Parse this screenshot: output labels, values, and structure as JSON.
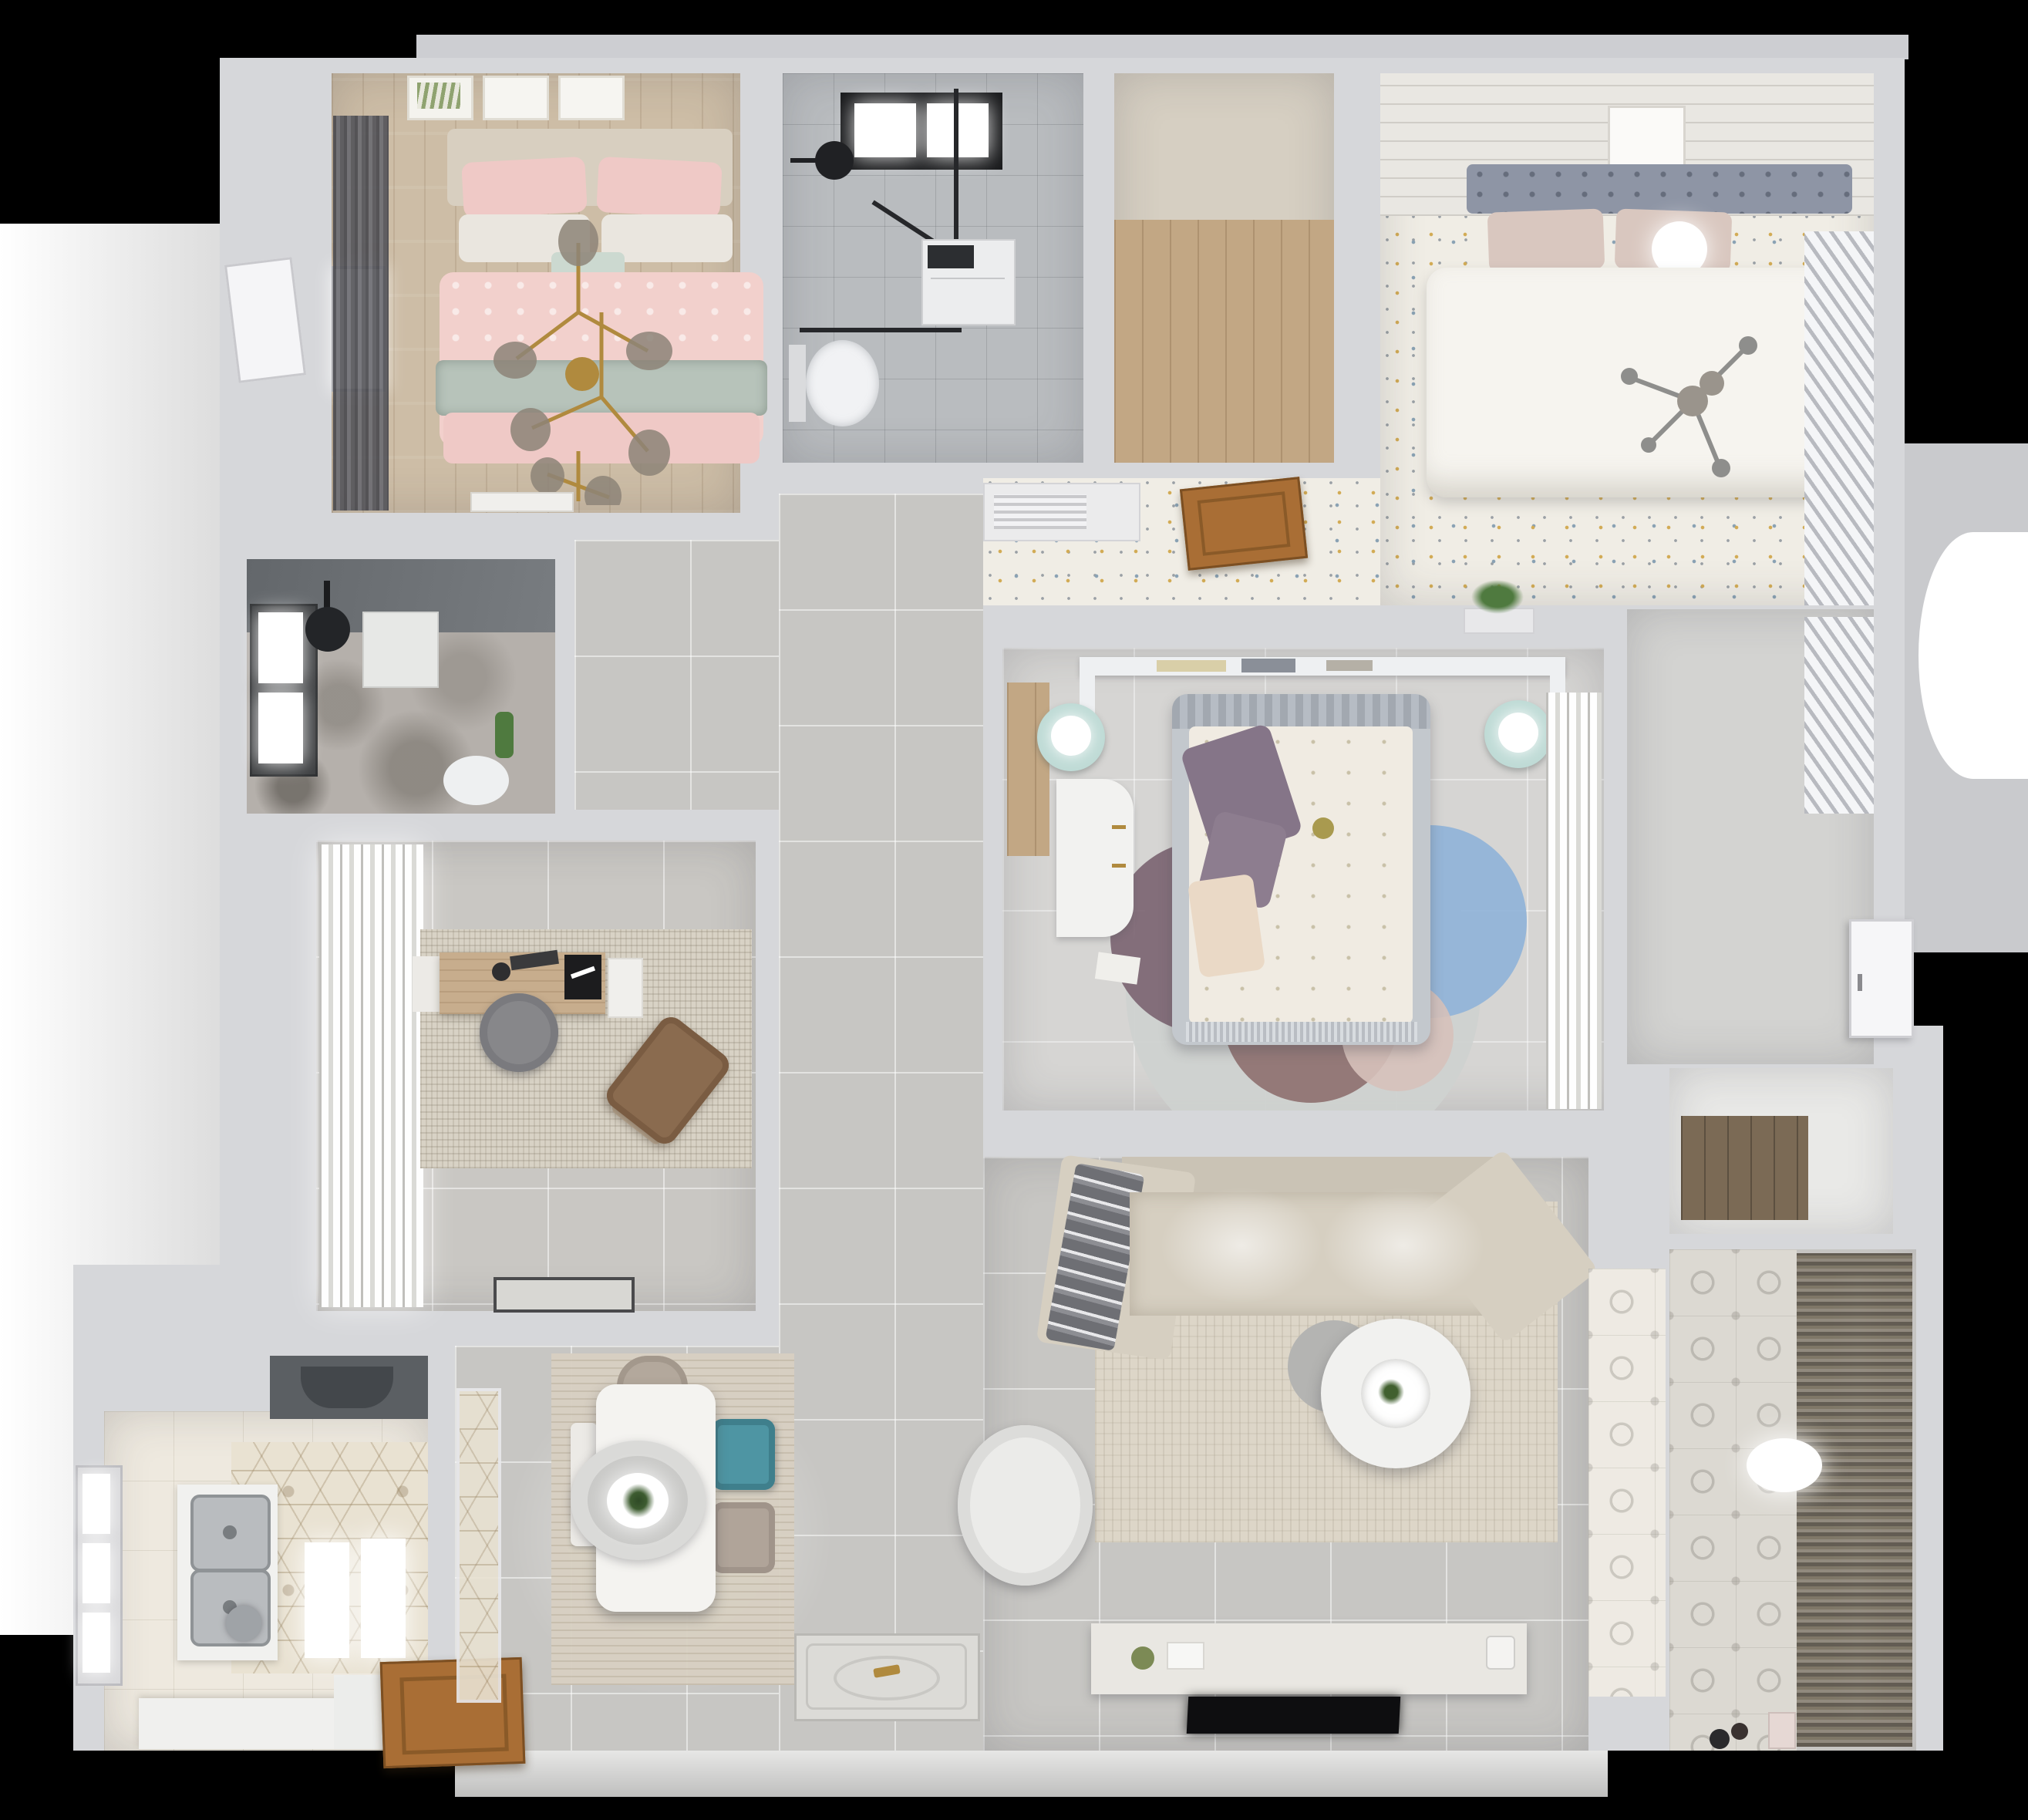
{
  "scene": {
    "title": "Top-down 3D render of a furnished apartment floor plan on a black background",
    "view": "bird's-eye dollhouse",
    "background": "#000000"
  },
  "palette": {
    "wall": "#d6d7da",
    "outerGray": "#cdced2",
    "outerLight": "#f3f3f2",
    "tileGray": "#c7c6c3",
    "bathTile": "#b9bcbf",
    "woodBeige": "#cdbda6",
    "woodOak": "#c2a784",
    "woodDark": "#7b6a55",
    "doorWood": "#a96e35",
    "bed1Pink": "#f2d0cc",
    "bed1PinkDeep": "#efc9c6",
    "sage": "#b7c3ba",
    "headboardBeige": "#d8cfc0",
    "curtainDark": "#5b5b60",
    "speckleBase": "#f0ede5",
    "speckleYellow": "#d2ab55",
    "speckleBlue": "#8aa2b4",
    "speckleGray": "#9aa0a5",
    "headboard2": "#8e95a5",
    "blush": "#d9c7bf",
    "showerWall": "#6e7276",
    "marble": "#b5b0ab",
    "studyRug": "#d8d2c5",
    "deskWood": "#c7ad8d",
    "chairGray": "#87878a",
    "loungeBrown": "#8a6b4f",
    "bedFrame3": "#c3c8cd",
    "duvet3": "#f0ebe2",
    "purple": "#857588",
    "cream": "#ead9c6",
    "teal": "#bfdbd6",
    "rugBase": "#cfd2d0",
    "rugBlue": "#8fb3d8",
    "rugPlum": "#7a6370",
    "rugMauve": "#8d6f6e",
    "rugTeal": "#a3bcb6",
    "rugPink": "#d6c1ba",
    "sofaBeige": "#d6cfc1",
    "sofaBack": "#cac3b5",
    "blanketGray": "#6e6f74",
    "livingRug": "#ddd6c8",
    "consoleWhite": "#e9e7e2",
    "tvBlack": "#0e0e10",
    "hexTile": "#e9e2d2",
    "hood": "#5b5f63",
    "steel": "#b9bcbf",
    "chairDiningBeige": "#b3a89c",
    "chairDiningTeal": "#4e95a3",
    "chairDiningBeige2": "#b0a499",
    "balconyTile": "#dcd9d2",
    "blinds": "#6a6157",
    "blindsLight": "#8c8478",
    "gold": "#b08a3e",
    "plantGreen": "#4f7a3f",
    "black": "#1c1d1f"
  },
  "rooms": [
    {
      "id": "bedroom-pink",
      "position": "top-left",
      "furniture": [
        "three-wall-art-frames",
        "upholstered-headboard",
        "pink-patterned-pillows",
        "white-pillows",
        "teal-accent-pillow",
        "pink-duvet-bed",
        "sage-green-throw",
        "gold-branch-chandelier",
        "dark-gray-curtains",
        "window",
        "bench"
      ]
    },
    {
      "id": "bathroom-shower",
      "position": "top-middle",
      "furniture": [
        "black-framed-skylight",
        "black-rain-shower-head",
        "black-glass-shower-enclosure",
        "washing-machine",
        "wall-hung-toilet"
      ]
    },
    {
      "id": "walk-in-closet-empty",
      "position": "top-middle-right",
      "furniture": [
        "oak-plank-floor"
      ]
    },
    {
      "id": "bedroom-white",
      "position": "top-right",
      "furniture": [
        "paneled-ceiling-band",
        "art-frame",
        "gray-tufted-headboard",
        "blush-pillows",
        "globe-lamp",
        "white-duvet-bed",
        "gray-chandelier",
        "louvered-shutter-wardrobe",
        "louvered-cabinet",
        "open-wood-door",
        "confetti-pattern-floor"
      ]
    },
    {
      "id": "shower-room-dark",
      "position": "middle-left",
      "furniture": [
        "dark-tiled-wall",
        "window",
        "ceiling-black-shower-head",
        "shower-tray",
        "toilet",
        "plant",
        "marble-floor"
      ]
    },
    {
      "id": "study",
      "position": "middle-left-lower",
      "furniture": [
        "billowy-white-curtains",
        "textured-area-rug",
        "wood-desk",
        "desk-accessories",
        "black-screen",
        "gray-swivel-chair",
        "brown-lounge-chair",
        "ottoman",
        "entry-doormat"
      ]
    },
    {
      "id": "master-bedroom",
      "position": "center",
      "furniture": [
        "white-shelf-headboard-with-books",
        "two-teal-nightstands-with-lamps",
        "gray-frame-bed",
        "floral-duvet",
        "purple-pillows",
        "cream-pillow",
        "white-desk-with-gold-handles",
        "multicolor-circle-rug",
        "sheer-curtain-wardrobe",
        "wood-floor-nook",
        "divider-plant"
      ]
    },
    {
      "id": "living-room",
      "position": "bottom-center-right",
      "furniture": [
        "beige-sectional-sofa",
        "gray-throw-blanket",
        "cream-area-rug",
        "round-two-tier-coffee-table",
        "white-swivel-armchair",
        "tv-console-with-decor",
        "flat-tv",
        "ceiling-light-pools",
        "patterned-tile-strip"
      ]
    },
    {
      "id": "kitchen",
      "position": "bottom-left",
      "furniture": [
        "range-hood",
        "hexagon-motif-tile-floor",
        "double-stainless-sink",
        "white-counters",
        "glowing-light-panels",
        "faucet",
        "open-wood-door",
        "window"
      ]
    },
    {
      "id": "dining-area",
      "position": "bottom-middle",
      "furniture": [
        "light-wood-rug",
        "white-rectangular-table",
        "concentric-ring-pendant-lamp-with-plant",
        "beige-chair",
        "teal-chair",
        "second-beige-chair",
        "white-bench",
        "ornate-entry-doormat"
      ]
    },
    {
      "id": "hallway",
      "position": "center-vertical",
      "furniture": [
        "gray-tile-floor"
      ]
    },
    {
      "id": "right-hall-closet",
      "position": "right-middle",
      "furniture": [
        "louvered-shutters",
        "white-door"
      ]
    },
    {
      "id": "storage-nook",
      "position": "right-lower",
      "furniture": [
        "dark-wood-shelf"
      ]
    },
    {
      "id": "balcony-laundry",
      "position": "bottom-right",
      "furniture": [
        "motif-tile-wall",
        "dark-slatted-blinds",
        "white-ceiling-lamp",
        "small-toys",
        "small-cylinders"
      ]
    }
  ]
}
